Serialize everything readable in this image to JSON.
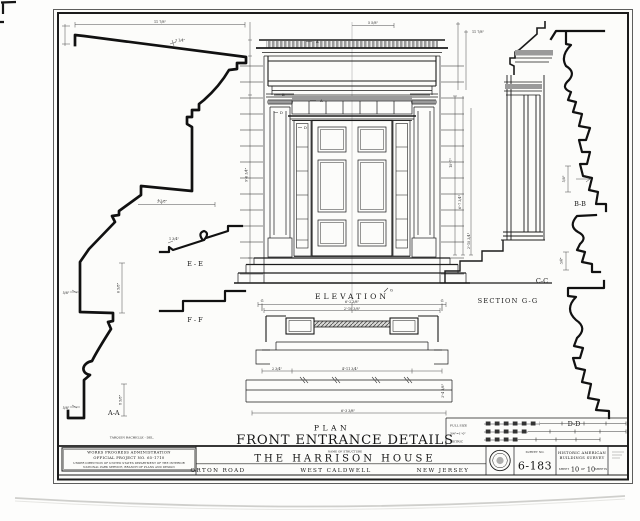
{
  "sheet": {
    "title": "FRONT ENTRANCE DETAILS",
    "drawing_labels": {
      "plan": "PLAN",
      "elevation": "ELEVATION",
      "section_gg": "SECTION G-G",
      "aa": "A-A",
      "bb": "B-B",
      "cc": "C-C",
      "dd": "D-D",
      "ee": "E - E",
      "ff": "F - F"
    },
    "delineator": "TARQUIN RACHELLE - DEL.",
    "cut_refs": [
      "A",
      "A",
      "B",
      "D",
      "D",
      "G",
      "G",
      "G"
    ],
    "dims": [
      "11 7/8\"",
      "3 1/4\"",
      "3 1/8\"",
      "6 5/8\"",
      "5/8\"",
      "8 5/8\"",
      "5/8\"",
      "1 3/4\"",
      "10'-7\"",
      "6'-7 3/4\"",
      "2'-10 3/4\"",
      "6'-2 3/8\"",
      "2'-10 3/8\"",
      "4'-11 3/4\"",
      "6'-3 3/8\"",
      "2 3/4\"",
      "5/8\"",
      "3/4\"",
      "11 7/8\"",
      "9'-6 3/4\"",
      "5 5/8\"",
      "3'-4 3/8\""
    ]
  },
  "title_block": {
    "wpa": [
      "WORKS PROGRESS ADMINISTRATION",
      "OFFICIAL PROJECT NO. 65-1710",
      "UNDER DIRECTION OF UNITED STATES DEPARTMENT OF THE INTERIOR",
      "NATIONAL PARK SERVICE, BRANCH OF PLANS AND DESIGN"
    ],
    "name_of_structure_label": "NAME OF STRUCTURE",
    "structure_name": "THE HARRISON HOUSE",
    "address": {
      "road": "ORTON ROAD",
      "city": "WEST CALDWELL",
      "state": "NEW JERSEY"
    },
    "survey": {
      "label": "SURVEY NO.",
      "number": "6-183"
    },
    "habs": {
      "line1": "HISTORIC AMERICAN",
      "line2": "BUILDINGS SURVEY",
      "sheet_prefix": "SHEET",
      "sheet_num": "10",
      "of": "OF",
      "total": "10",
      "sheets_suffix": "SHEETS"
    }
  },
  "scale_block": {
    "full_size": "FULL SIZE",
    "scale": "3/4\"=1'-0\"",
    "metric": "METRIC"
  },
  "colors": {
    "ink": "#1b1b1b",
    "paper": "#fcfcfa",
    "shade": "#9a9a9a"
  }
}
